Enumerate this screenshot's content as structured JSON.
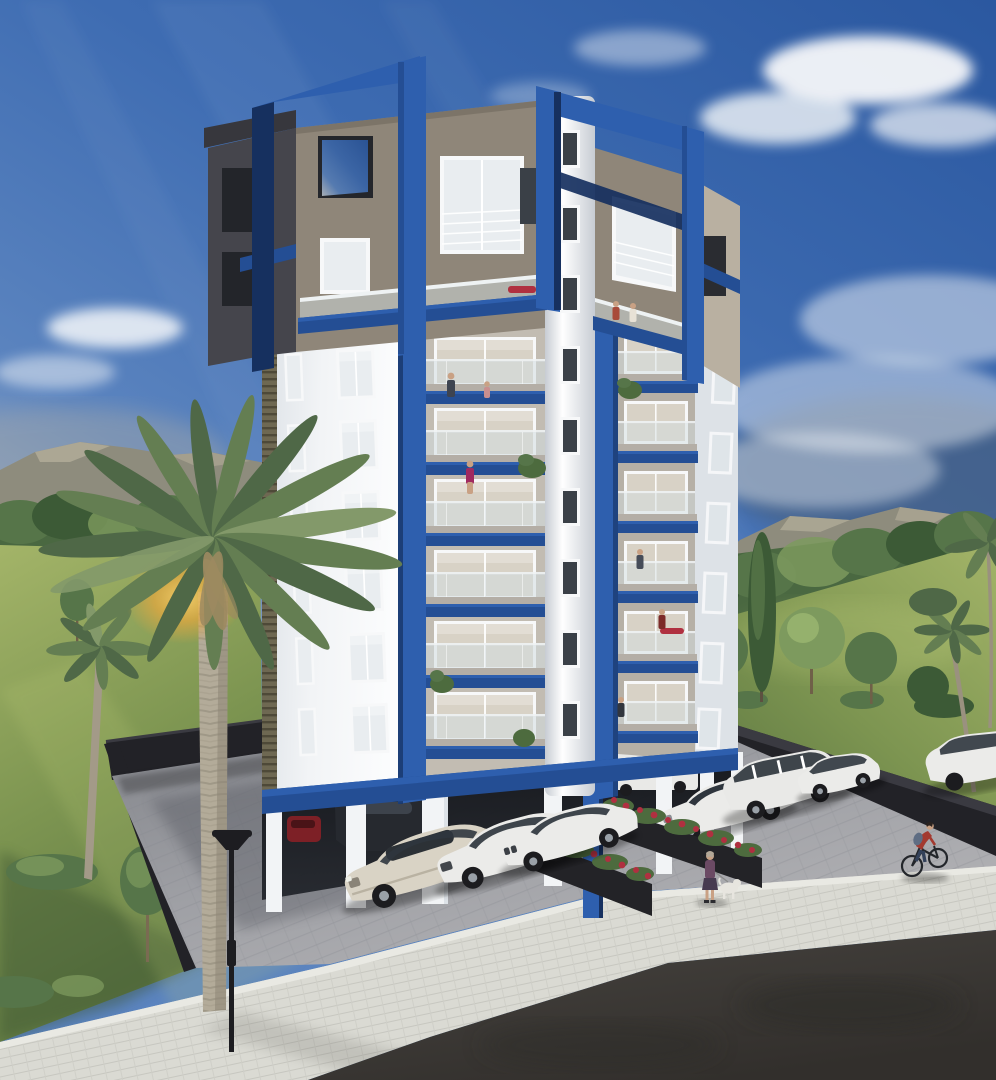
{
  "scene": {
    "type": "architectural-render",
    "description": "Daylight 3D exterior rendering of a modern 8-storey apartment tower with navy-blue pergola frames and balcony fascias, open pilotis parking at ground level, palm trees, lawns, parked cars, a woman walking a dog and a cyclist",
    "time_of_day": "day",
    "weather": "partly cloudy"
  },
  "palette": {
    "sky_top": "#2b58a0",
    "sky_high": "#3e6cb2",
    "sky_mid": "#5b84bf",
    "sky_low": "#93a3b4",
    "horizon_haze": "#b6bdc4",
    "cloud": "#f5f7f9",
    "sky_slate": "#4e5d6e",
    "mountain": "#8e8c7d",
    "mountain_lit": "#b9b29e",
    "treeline_back": "#4a6841",
    "tree_dark": "#3c5a36",
    "tree_mid": "#567549",
    "tree_light": "#7d9a5e",
    "lawn_light": "#a3b468",
    "lawn_mid": "#7d9551",
    "lawn_dark": "#5a7440",
    "palm_dark": "#4f6847",
    "palm_mid": "#647e52",
    "palm_light": "#83996a",
    "palm_trunk": "#b3ab99",
    "palm_trunk_dark": "#8c8575",
    "frond_dry": "#9c8a60",
    "glow": "#e8a83e",
    "blue_lit": "#2e5fae",
    "blue_mid": "#244e94",
    "blue_dark": "#16305f",
    "facade_white": "#f2f4f6",
    "facade_white_shade": "#dde2e7",
    "facade_gray": "#c2bcb2",
    "facade_gray2": "#b6b0a6",
    "facade_taupe": "#8f8679",
    "taupe_light": "#b9b0a1",
    "facade_dark": "#45454c",
    "parapet_dark": "#37373d",
    "louver": "#6e6852",
    "core_light": "#ffffff",
    "core_shade": "#c7ccd3",
    "glass_rail": "#d3dde0",
    "window_glass": "#e9edf0",
    "window_glass_warm": "#d8d2c6",
    "window_frame": "#f7f8f9",
    "window_dark": "#3a4047",
    "slab": "#b4aea6",
    "wall_dark": "#222227",
    "wall_top": "#3a3a41",
    "paver": "#9fa0a5",
    "paver_dark": "#7e8086",
    "sidewalk": "#dadad3",
    "curb": "#e9e9e3",
    "asphalt": "#474440",
    "asphalt_dark": "#322f2c",
    "planter": "#232327",
    "flower_red": "#b03040",
    "leaf": "#4d6b3e",
    "car_cream": "#d9d3c5",
    "car_white": "#ebebe9",
    "car_glass": "#2f363e",
    "tire": "#1c1c1f",
    "hub": "#9aa1a8",
    "car_red": "#7d2026",
    "car_dark": "#26292f",
    "van_white": "#e9e9e7",
    "lamp": "#1d1d21",
    "skin": "#c9a184",
    "hair_grey": "#b3a898",
    "dress_purple": "#6b4a64",
    "skirt_dark": "#473a50",
    "shirt_red": "#a33a30",
    "pants_dark": "#33415a",
    "backpack": "#5e6d83",
    "dog_white": "#e7e5df",
    "bike": "#23262b"
  },
  "building": {
    "floors_visible": 8,
    "balcony_levels": 6,
    "balcony_bays": 2,
    "rooftop_pergola_frames": 2,
    "ground_level": "open pilotis parking",
    "accent_color_name": "navy blue",
    "facade_colors": [
      "white",
      "light gray",
      "taupe",
      "dark charcoal"
    ]
  },
  "vegetation": {
    "foreground_palms": 2,
    "right_edge_palms": 3,
    "lawn_trees_left": 2,
    "lawn_trees_right": 5,
    "flower_color_name": "red"
  },
  "vehicles": [
    {
      "id": "sedan-cream-large",
      "color_name": "cream",
      "location": "front row"
    },
    {
      "id": "sedan-white-mid",
      "color_name": "white",
      "location": "front row"
    },
    {
      "id": "sedan-white-right",
      "color_name": "white",
      "location": "front row"
    },
    {
      "id": "sedan-white-east",
      "color_name": "white",
      "location": "right row"
    },
    {
      "id": "minivan-white",
      "color_name": "white",
      "location": "right row"
    },
    {
      "id": "hatchback-white",
      "color_name": "white",
      "location": "right row"
    },
    {
      "id": "suv-white-partial",
      "color_name": "white",
      "location": "far right edge"
    },
    {
      "id": "car-red-garage",
      "color_name": "red",
      "location": "under building"
    },
    {
      "id": "car-dark-garage",
      "color_name": "dark gray",
      "location": "under building"
    },
    {
      "id": "van-white-garage",
      "color_name": "white",
      "location": "under building"
    }
  ],
  "people": [
    {
      "id": "dog-walker",
      "detail": "woman in purple dress walking a white dog"
    },
    {
      "id": "cyclist",
      "detail": "rider in dark red shirt with backpack on sidewalk"
    },
    {
      "id": "balcony-residents",
      "count": 8
    }
  ],
  "street_furniture": {
    "lamp_posts": 1,
    "planter_rows": 2
  }
}
